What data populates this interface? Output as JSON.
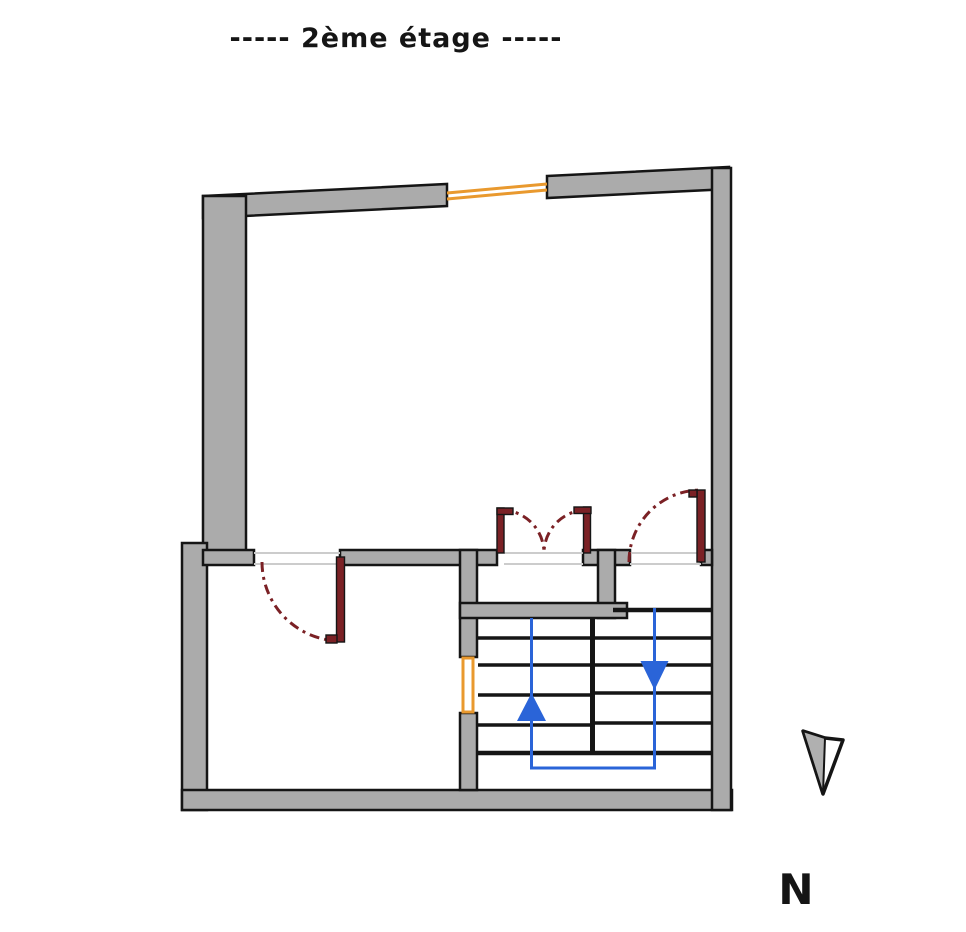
{
  "title": "-----  2ème étage  -----",
  "compass": {
    "label": "N",
    "icon": "north-arrow-icon"
  },
  "stairs": {
    "up_icon": "arrow-up-icon",
    "down_icon": "arrow-down-icon"
  },
  "colors": {
    "background": "#ffffff",
    "wall-fill": "#ababab",
    "outline": "#151515",
    "door-red": "#7b2125",
    "window-orange": "#e9992e",
    "stair-blue": "#2a64d8",
    "threshold-gray": "#cccccc",
    "compass-fill": "#b0b0b0"
  }
}
